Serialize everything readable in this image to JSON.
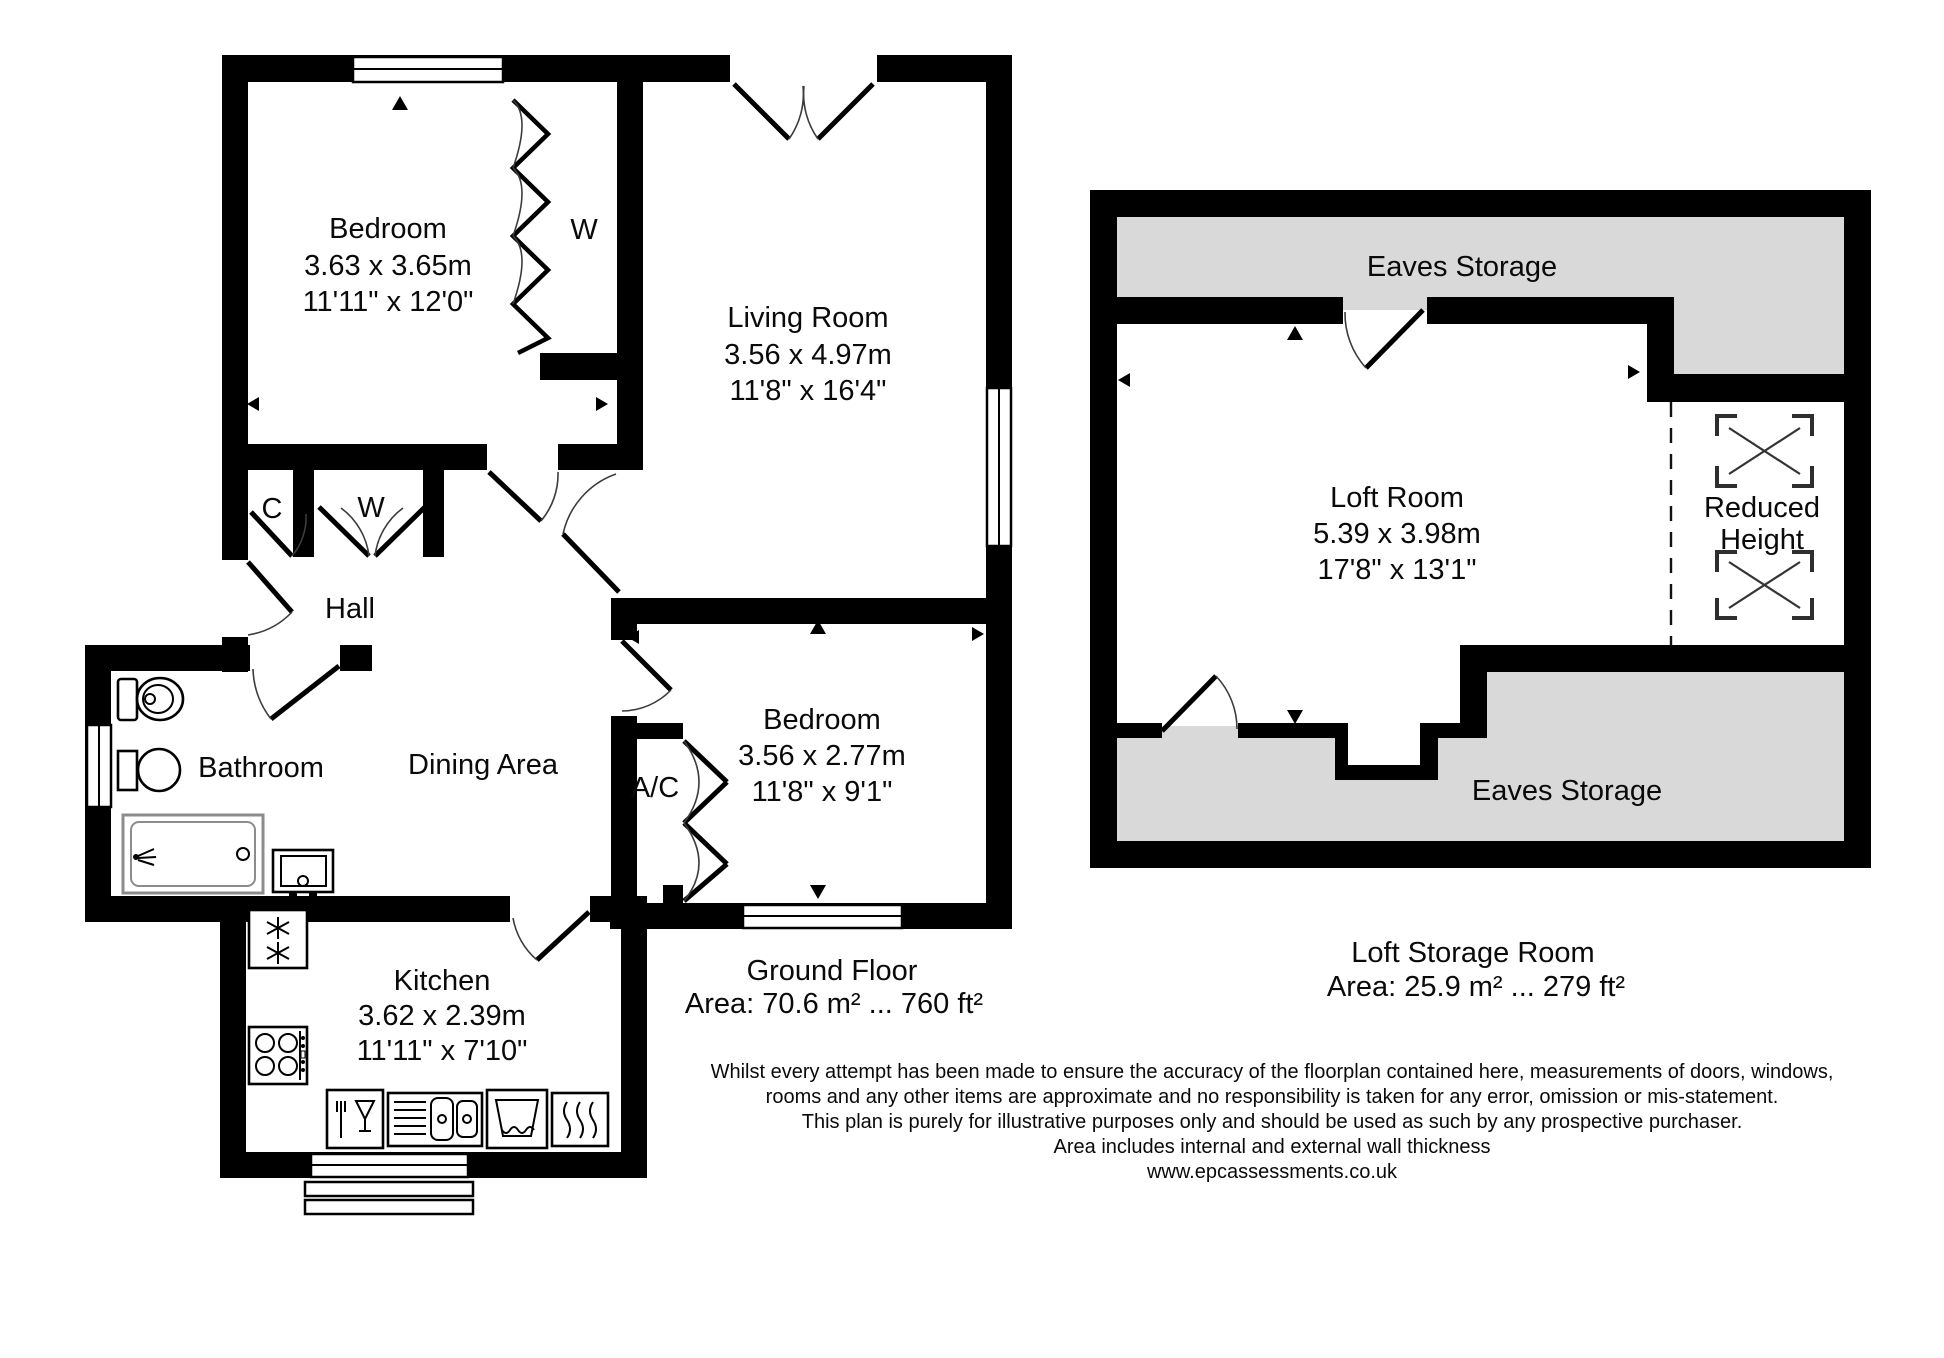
{
  "colors": {
    "wall": "#000000",
    "eaves_fill": "#d9d9d9",
    "background": "#ffffff"
  },
  "ground": {
    "title": "Ground Floor",
    "area": "Area: 70.6 m² ... 760 ft²",
    "rooms": {
      "bedroom1": {
        "name": "Bedroom",
        "metric": "3.63 x 3.65m",
        "imperial": "11'11\" x 12'0\""
      },
      "living": {
        "name": "Living Room",
        "metric": "3.56 x 4.97m",
        "imperial": "11'8\" x 16'4\""
      },
      "bedroom2": {
        "name": "Bedroom",
        "metric": "3.56 x 2.77m",
        "imperial": "11'8\" x 9'1\""
      },
      "kitchen": {
        "name": "Kitchen",
        "metric": "3.62 x 2.39m",
        "imperial": "11'11\" x 7'10\""
      },
      "bathroom": {
        "name": "Bathroom"
      },
      "hall": {
        "name": "Hall"
      },
      "dining": {
        "name": "Dining Area"
      },
      "airing_cupboard": {
        "name": "A/C"
      },
      "wardrobe": {
        "name": "W"
      },
      "closet_c": {
        "name": "C"
      },
      "closet_w": {
        "name": "W"
      }
    }
  },
  "loft": {
    "title": "Loft Storage Room",
    "area": "Area: 25.9 m² ... 279 ft²",
    "rooms": {
      "loft_room": {
        "name": "Loft Room",
        "metric": "5.39 x 3.98m",
        "imperial": "17'8\" x 13'1\""
      }
    },
    "labels": {
      "eaves_top": "Eaves Storage",
      "eaves_bottom": "Eaves Storage",
      "reduced_height_1": "Reduced",
      "reduced_height_2": "Height"
    }
  },
  "disclaimer": {
    "line1": "Whilst every attempt has been made to ensure the accuracy of the floorplan contained here, measurements of doors, windows,",
    "line2": "rooms and any other items are approximate and no responsibility is taken for any error, omission or mis-statement.",
    "line3": "This plan is purely for illustrative purposes only and should be used as such by any prospective purchaser.",
    "line4": "Area includes internal and external wall thickness",
    "line5": "www.epcassessments.co.uk"
  }
}
